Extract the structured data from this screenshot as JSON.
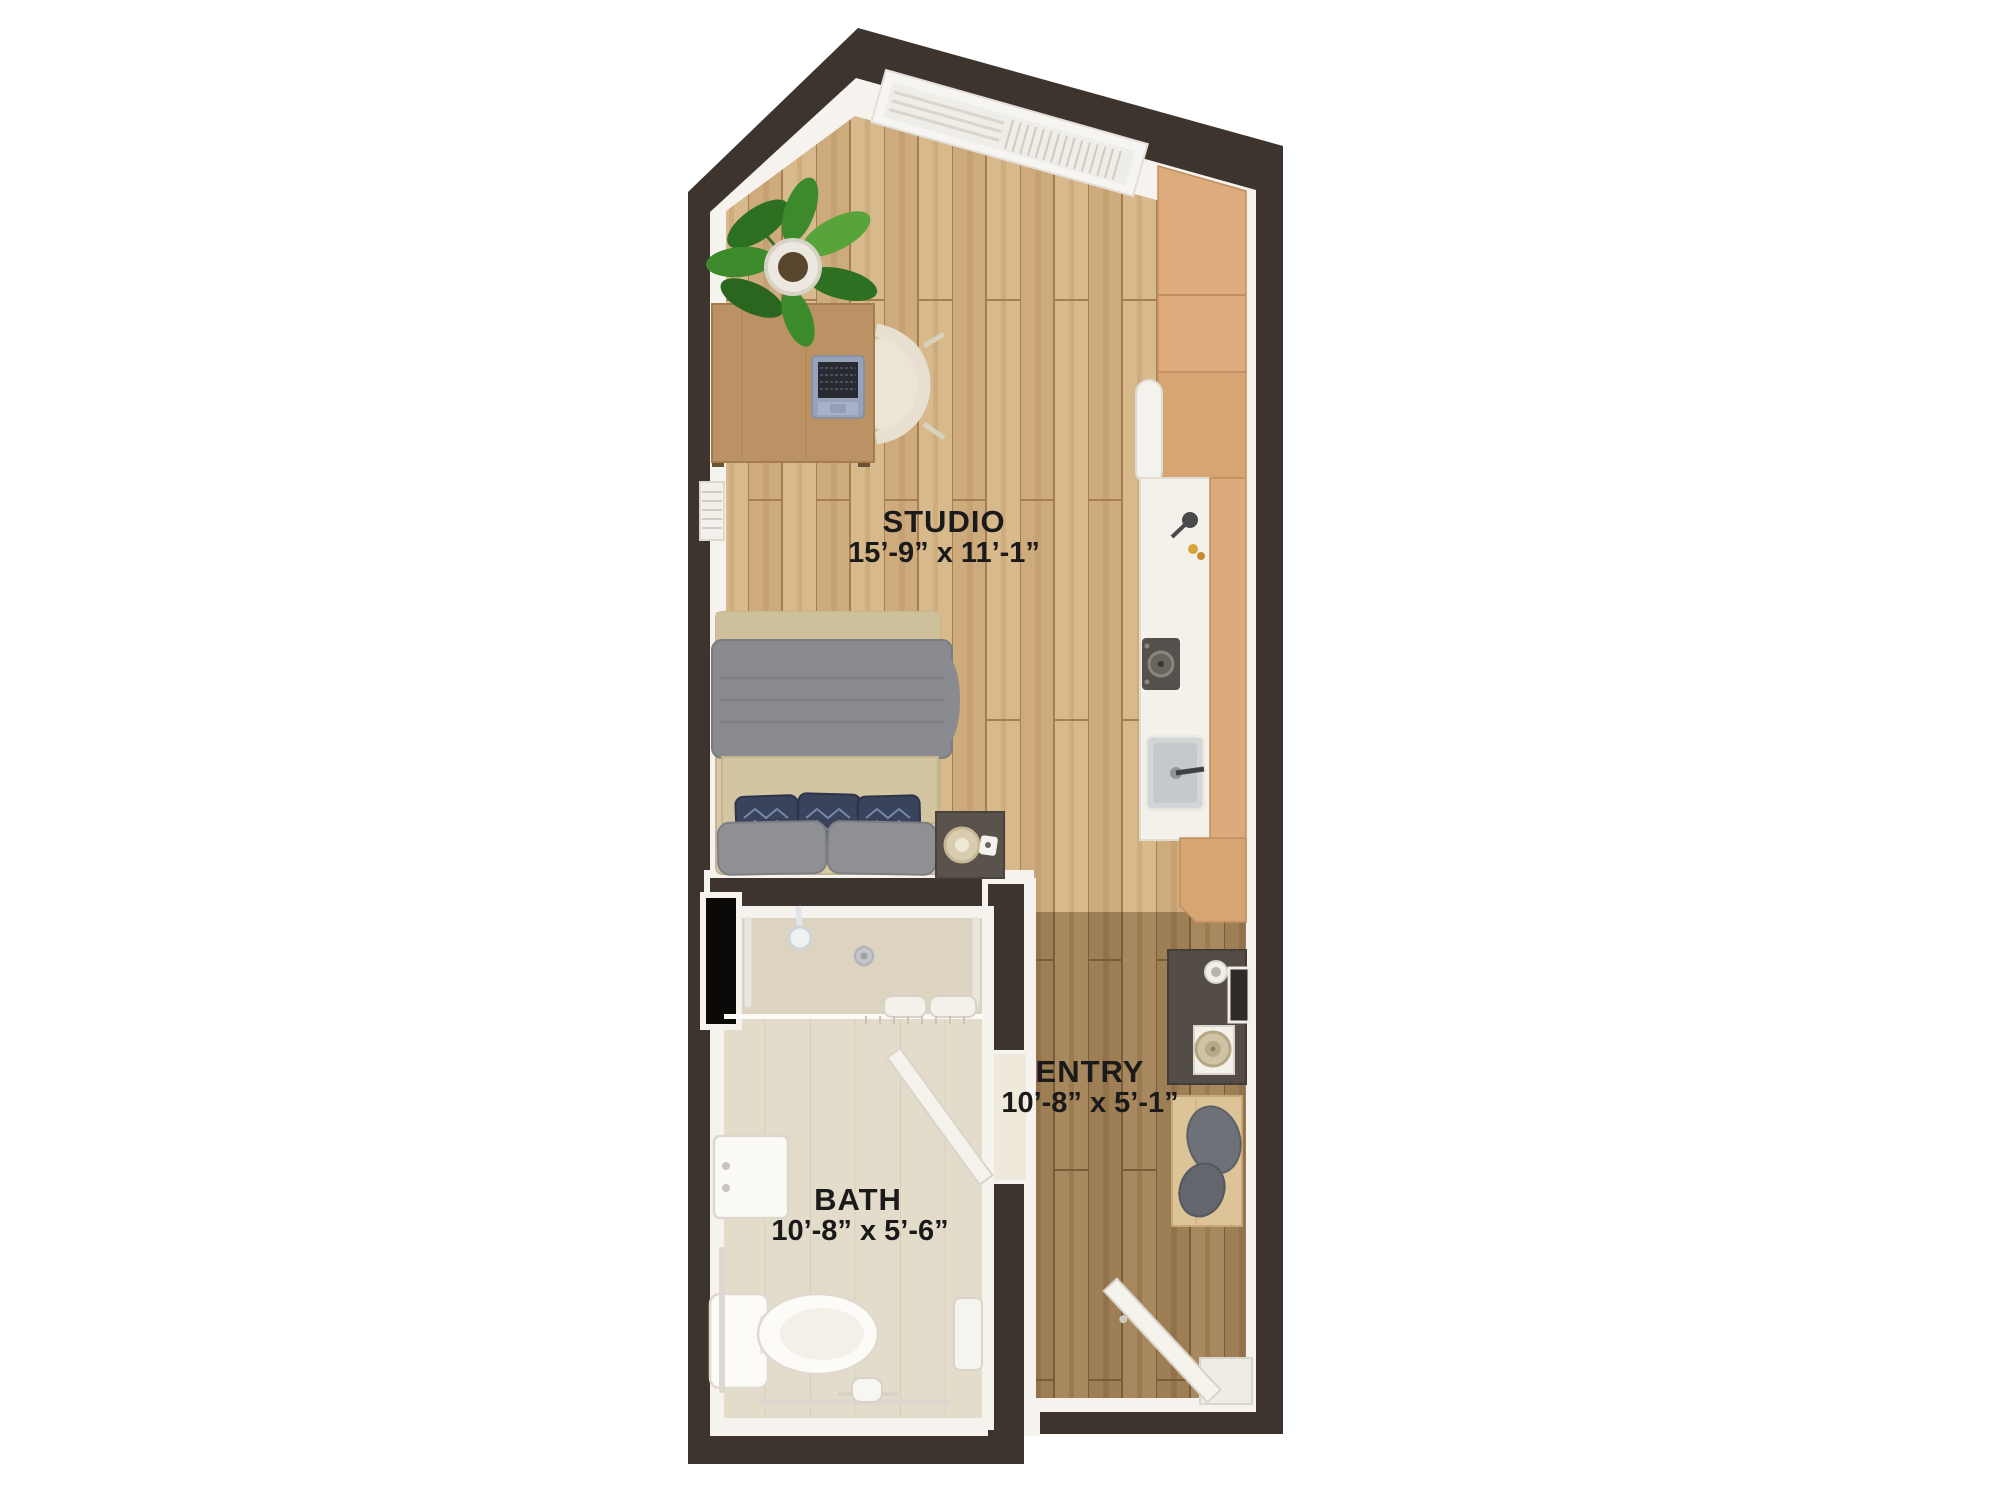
{
  "floor_plan": {
    "rooms": [
      {
        "id": "studio",
        "label": "STUDIO",
        "dimensions": "15’-9” x 11’-1”"
      },
      {
        "id": "entry",
        "label": "ENTRY",
        "dimensions": "10’-8” x 5’-1”"
      },
      {
        "id": "bath",
        "label": "BATH",
        "dimensions": "10’-8” x 5’-6”"
      }
    ],
    "colors": {
      "wall": "#3c342d",
      "trim": "#f6f3ee",
      "studio_wood_floor": "#cdab7c",
      "entry_wood_floor": "#9d7e55",
      "bath_floor": "#e3dcca",
      "cabinet_tan": "#dcaa7a",
      "counter_white": "#f4f1ea",
      "label_text": "#1a1a1a",
      "background": "#ffffff"
    },
    "fixtures": [
      "window-blinds",
      "potted-plant",
      "desk",
      "laptop",
      "desk-chair",
      "wall-radiator",
      "bed",
      "duvet",
      "accent-pillows",
      "nightstand",
      "lamp",
      "upper-cabinets",
      "refrigerator",
      "kitchen-counter",
      "faucet",
      "cooktop",
      "kitchen-sink",
      "tall-cabinet",
      "base-cabinet",
      "console-table",
      "cup",
      "tray",
      "magazine",
      "woven-basket",
      "bench",
      "draped-cloth",
      "shower-head",
      "floor-drain",
      "glass-partition",
      "towels",
      "grab-bars",
      "bathroom-sink",
      "toilet",
      "toilet-paper-holder",
      "wall-towel",
      "bathroom-door",
      "entry-door",
      "door-threshold",
      "wall-niche"
    ]
  }
}
